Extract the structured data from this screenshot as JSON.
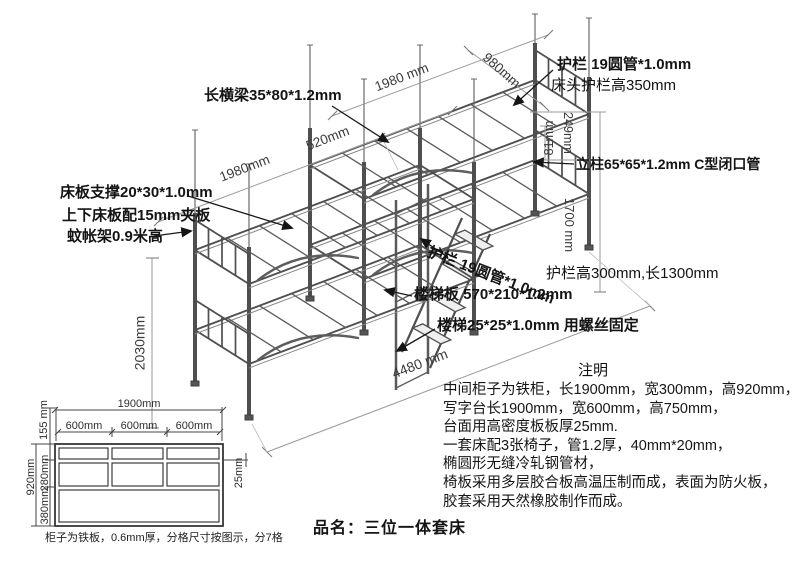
{
  "drawing": {
    "dims": {
      "left_length": "1980mm",
      "gap_width": "520mm",
      "right_length": "1980 mm",
      "bed_width": "980mm",
      "left_height": "2030mm",
      "rail_offset": "81mm",
      "guard_height": "249mm",
      "lower_height": "1700 mm",
      "total_length": "4480 mm"
    },
    "callouts": {
      "long_beam": "长横梁35*80*1.2mm",
      "top_guard": "护栏 19圆管*1.0mm",
      "head_guard": "床头护栏高350mm",
      "post": "立柱65*65*1.2mm C型闭口管",
      "bed_support": "床板支撑20*30*1.0mm",
      "bed_board": "上下床板配15mm夹板",
      "net_frame": "蚊帐架0.9米高",
      "mid_guard": "护栏 19圆管*1.0mm",
      "guard_size": "护栏高300mm,长1300mm",
      "ladder_board": "楼梯板 570*210*1.2mm",
      "ladder": "楼梯25*25*1.0mm 用螺丝固定"
    }
  },
  "notes": {
    "title": "注明",
    "lines": [
      "中间柜子为铁柜，长1900mm，宽300mm，高920mm，",
      "写字台长1900mm，宽600mm，高750mm，",
      "台面用高密度板板厚25mm.",
      "一套床配3张椅子，管1.2厚，40mm*20mm，",
      "椭圆形无缝冷轧钢管材，",
      "椅板采用多层胶合板高温压制而成，表面为防火板，",
      "胶套采用天然橡胶制作而成。"
    ]
  },
  "cabinet": {
    "dims": {
      "total_width": "1900mm",
      "cell1": "600mm",
      "cell2": "600mm",
      "cell3": "600mm",
      "total_height": "920mm",
      "row1": "155 mm",
      "row2": "280mm",
      "row3": "380mm",
      "board_thickness": "25mm"
    },
    "caption": "柜子为铁板，0.6mm厚，分格尺寸按图示，分7格"
  },
  "product": {
    "name_line": "品名：三位一体套床"
  },
  "colors": {
    "structure": "#4f4f4f",
    "dimension": "#8f8f8f",
    "text": "#1a1a1a",
    "background": "#ffffff"
  }
}
